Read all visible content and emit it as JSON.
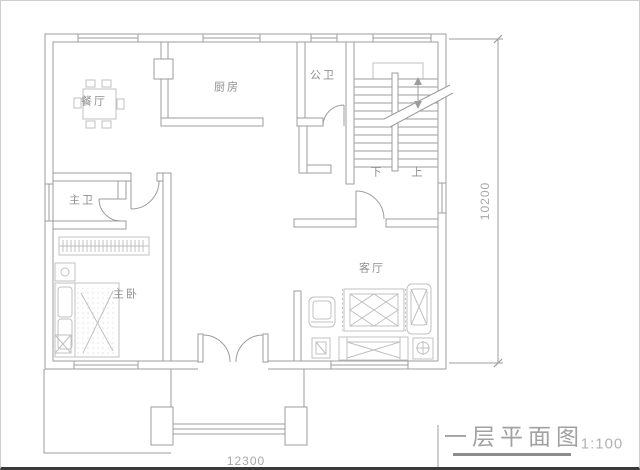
{
  "rooms": [
    {
      "name": "dining",
      "label": "餐厅"
    },
    {
      "name": "kitchen",
      "label": "厨房"
    },
    {
      "name": "public-bath",
      "label": "公卫"
    },
    {
      "name": "master-bath",
      "label": "主卫"
    },
    {
      "name": "master-bedroom",
      "label": "主卧"
    },
    {
      "name": "living",
      "label": "客厅"
    }
  ],
  "stairs": {
    "down": "下",
    "up": "上"
  },
  "dimensions": {
    "bottom": "12300",
    "right": "10200"
  },
  "titleblock": {
    "title": "一层平面图",
    "scale": "1:100"
  },
  "icons": [
    "dining-table-icon",
    "wardrobe-icon",
    "bed-icon",
    "nightstand-icon",
    "sofa-icon",
    "rug-icon",
    "armchair-icon",
    "lounge-chair-icon",
    "side-table-icon",
    "stairs-icon",
    "double-entry-door-icon",
    "window-icon"
  ],
  "colors": {
    "wall_line": "#9d9d9d",
    "furniture_line": "#c0c0c0",
    "label_text": "#8f8f8f",
    "dim_text": "#a8a8a8",
    "title_text": "#a2a2a2",
    "title_underline": "#8c8c8c",
    "frame_border": "#cfcfcf",
    "frame_bottom": "#3a3a3a"
  }
}
